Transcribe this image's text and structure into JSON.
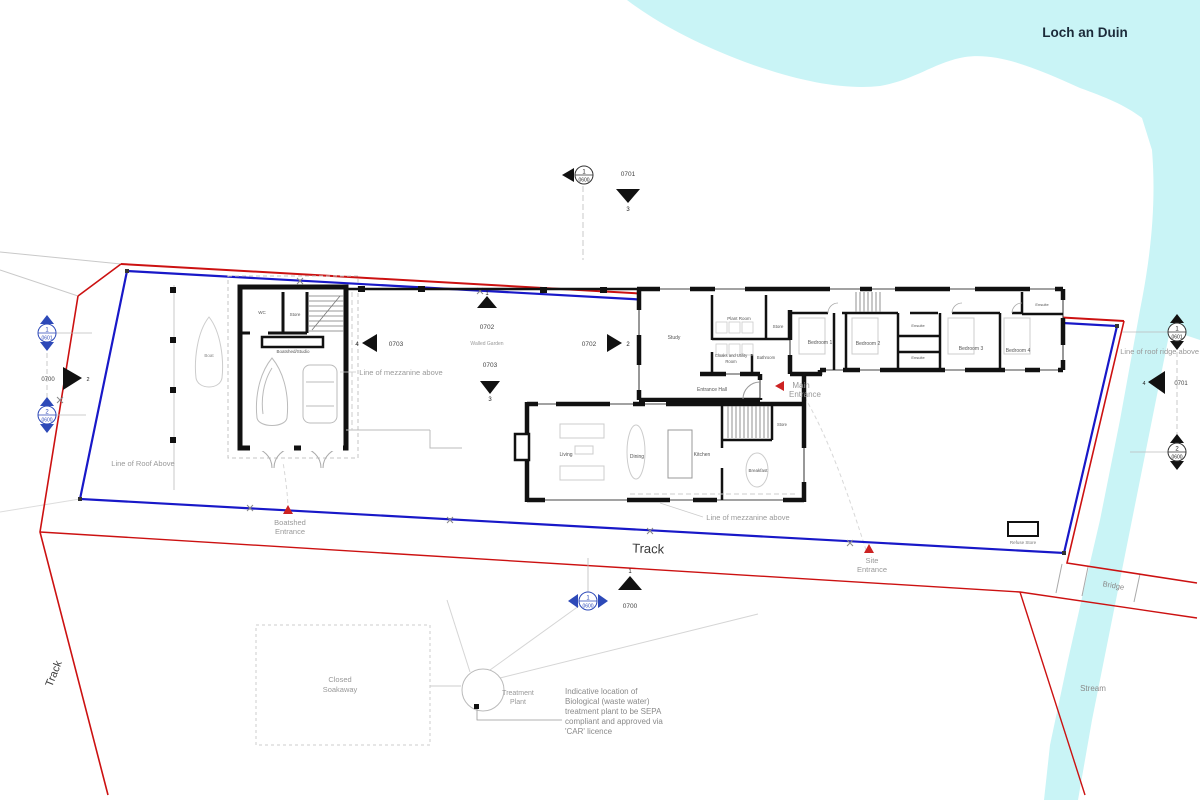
{
  "labels": {
    "loch": "Loch an Duin",
    "stream": "Stream",
    "bridge": "Bridge",
    "track": "Track",
    "track_left": "Track",
    "walled_garden": "Walled Garden",
    "mezzanine_upper": "Line of mezzanine above",
    "mezzanine_lower": "Line of mezzanine above",
    "roof_above": "Line of Roof Above",
    "roof_ridge": "Line of roof ridge above",
    "boatshed_entrance_l1": "Boatshed",
    "boatshed_entrance_l2": "Entrance",
    "site_entrance_l1": "Site",
    "site_entrance_l2": "Entrance",
    "main_entrance_l1": "Main",
    "main_entrance_l2": "Entrance",
    "closed_soakaway_l1": "Closed",
    "closed_soakaway_l2": "Soakaway",
    "treatment_plant_l1": "Treatment",
    "treatment_plant_l2": "Plant",
    "refuse_store": "Refuse Store",
    "boat": "Boat"
  },
  "note": [
    "Indicative location of",
    "Biological (waste water)",
    "treatment plant to be SEPA",
    "compliant and approved via",
    "'CAR' licence"
  ],
  "rooms": {
    "study": "Study",
    "plant_room": "Plant Room",
    "store_a": "Store",
    "cloaks_l1": "Cloaks and Utility",
    "cloaks_l2": "Room",
    "bathroom": "Bathroom",
    "entrance_hall": "Entrance Hall",
    "bedroom1": "Bedroom 1",
    "bedroom2": "Bedroom 2",
    "bedroom3": "Bedroom 3",
    "bedroom4": "Bedroom 4",
    "ensuite_a": "Ensuite",
    "ensuite_b": "Ensuite",
    "ensuite_c": "Ensuite",
    "living": "Living",
    "dining": "Dining",
    "kitchen": "Kitchen",
    "breakfast": "Breakfast",
    "store_b": "Store",
    "boatshed_wc": "WC",
    "boatshed_store": "Store",
    "boatshed_studio": "Boatshed/Studio"
  },
  "markers": {
    "top_section": {
      "num": "1",
      "sheet": "0600"
    },
    "top_elev": {
      "num": "3",
      "sheet": "0701"
    },
    "left_section_1": {
      "num": "1",
      "sheet": "0601"
    },
    "left_elev": {
      "num": "2",
      "sheet": "0700"
    },
    "left_section_2": {
      "num": "2",
      "sheet": "0600"
    },
    "right_section_1": {
      "num": "1",
      "sheet": "0601"
    },
    "right_elev": {
      "num": "4",
      "sheet": "0701"
    },
    "right_section_2": {
      "num": "2",
      "sheet": "0600"
    },
    "bottom_section": {
      "num": "1",
      "sheet": "0600"
    },
    "bottom_elev": {
      "num": "1",
      "sheet": "0700"
    },
    "garden_elev_up": {
      "num": "1",
      "sheet": "0702"
    },
    "garden_elev_down": {
      "num": "3",
      "sheet": "0703"
    },
    "garden_elev_left": {
      "num": "4",
      "sheet": "0703"
    },
    "garden_elev_right": {
      "num": "2",
      "sheet": "0702"
    }
  },
  "colors": {
    "water": "#c9f4f6",
    "boundary_red": "#cc1111",
    "boundary_blue": "#1818c8",
    "wall": "#111111",
    "annotation_gray": "#999999",
    "marker_blue": "#2d49b8",
    "entrance_red": "#cc2222",
    "loch_text": "#1c2b3a"
  }
}
